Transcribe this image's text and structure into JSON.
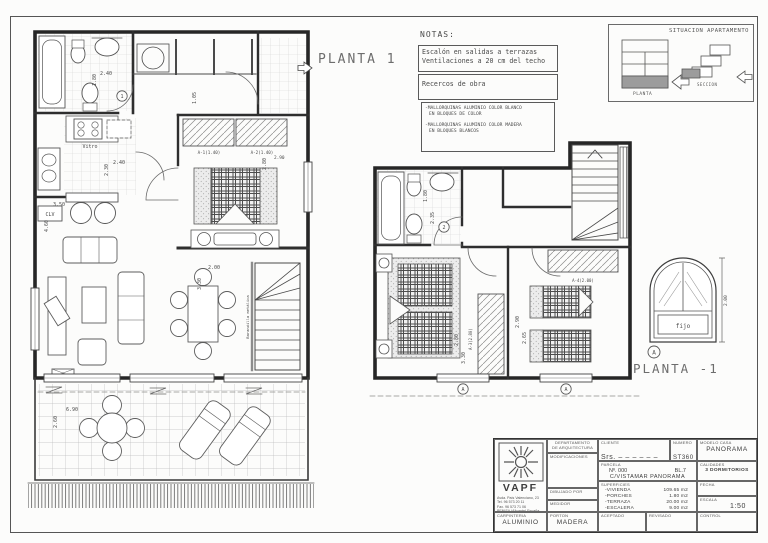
{
  "labels": {
    "planta1": "PLANTA 1",
    "planta_minus_1": "PLANTA -1"
  },
  "notas": {
    "title": "NOTAS:",
    "note1_line1": "Escalón en salidas a terrazas",
    "note1_line2": "Ventilaciones a 20 cm del techo",
    "note2": "Recercos de obra",
    "note3_item1_line1": "-MALLORQUINAS ALUMINIO COLOR BLANCO",
    "note3_item1_line2": "EN BLOQUES DE COLOR",
    "note3_item2_line1": "-MALLORQUINAS ALUMINIO COLOR MADERA",
    "note3_item2_line2": "EN BLOQUES BLANCOS"
  },
  "situacion": {
    "title": "SITUACION APARTAMENTO",
    "planta": "PLANTA",
    "seccion": "SECCION"
  },
  "plan1": {
    "dim_bath_width": "2.40",
    "dim_bath_height": "1.80",
    "door_marker": "1",
    "vitro": "Vitro",
    "clv": "CLV",
    "dim_kitchen_width": "2.40",
    "dim_kitchen_height": "2.30",
    "dim_kitchen_len": "3.50",
    "dim_living_height": "4.60",
    "dim_hall": "1.05",
    "wardrobe_a1": "A-1(1.40)",
    "wardrobe_a2": "A-2(1.40)",
    "dim_bed_width": "2.80",
    "dim_bed_width2": "2.90",
    "dim_dining_width": "2.00",
    "dim_dining_height": "3.30",
    "railing_label": "Barandilla metálica",
    "dim_terrace_width": "6.90",
    "dim_terrace_height": "2.60"
  },
  "plan2": {
    "dim_bath_height": "1.80",
    "dim_bath_height2": "2.35",
    "door_marker": "2",
    "wardrobe_a3": "A-3(2.80)",
    "wardrobe_a4": "A-4(2.00)",
    "dim_bed1_width": "2.80",
    "dim_bed1_height": "3.30",
    "dim_bed2_width": "2.90",
    "dim_bed2_height": "2.65",
    "window_marker": "A"
  },
  "window_detail": {
    "fijo": "fijo",
    "dim_height": "2.00",
    "marker": "A"
  },
  "titleblock": {
    "brand": "VAPF",
    "address_line1": "Avda. País Valenciano, 23",
    "address_line2": "Tel. 96 573 20 11",
    "address_line3": "Fax. 96 573 71 06",
    "address_line4": "BENISA (Alicante) España.",
    "dept_line1": "DEPARTAMENTO",
    "dept_line2": "DE ARQUITECTURA",
    "modificaciones_label": "MODIFICACIONES",
    "cliente_label": "CLIENTE",
    "cliente_value": "Srs.  ‒ ‒ ‒ ‒ ‒ ‒",
    "numero_label": "NUMERO",
    "numero_value": "ST360",
    "modelo_label": "MODELO CASA",
    "modelo_value": "PANORAMA",
    "parcela_label": "PARCELA",
    "parcela_num": "Nº. 000",
    "parcela_bl": "BL.7",
    "parcela_street": "C/VISTAMAR  PANORAMA",
    "calidades_label": "CALIDADES",
    "calidades_value": "3 DORMITORIOS",
    "superficies_label": "SUPERFICIES",
    "superficies": [
      {
        "name": "-VIVIENDA",
        "value": "109.65 m2"
      },
      {
        "name": "-PORCHES",
        "value": "1.80 m2"
      },
      {
        "name": "-TERRAZA",
        "value": "20.00 m2"
      },
      {
        "name": "-ESCALERA",
        "value": "9.00 m2"
      }
    ],
    "fecha_label": "FECHA",
    "fecha_value": "19-02-03",
    "escala_label": "ESCALA",
    "escala_value": "1:50",
    "dibujado_label": "DIBUJADO POR",
    "dibujado_value": "JOSE JUAN",
    "medidor_label": "MEDIDOR",
    "medidor_value": "000000",
    "carpinteria_label": "CARPINTERIA",
    "carpinteria_value": "ALUMINIO",
    "porton_label": "PORTON",
    "porton_value": "MADERA",
    "aceptado_label": "ACEPTADO",
    "revisado_label": "REVISADO",
    "control_label": "CONTROL"
  }
}
